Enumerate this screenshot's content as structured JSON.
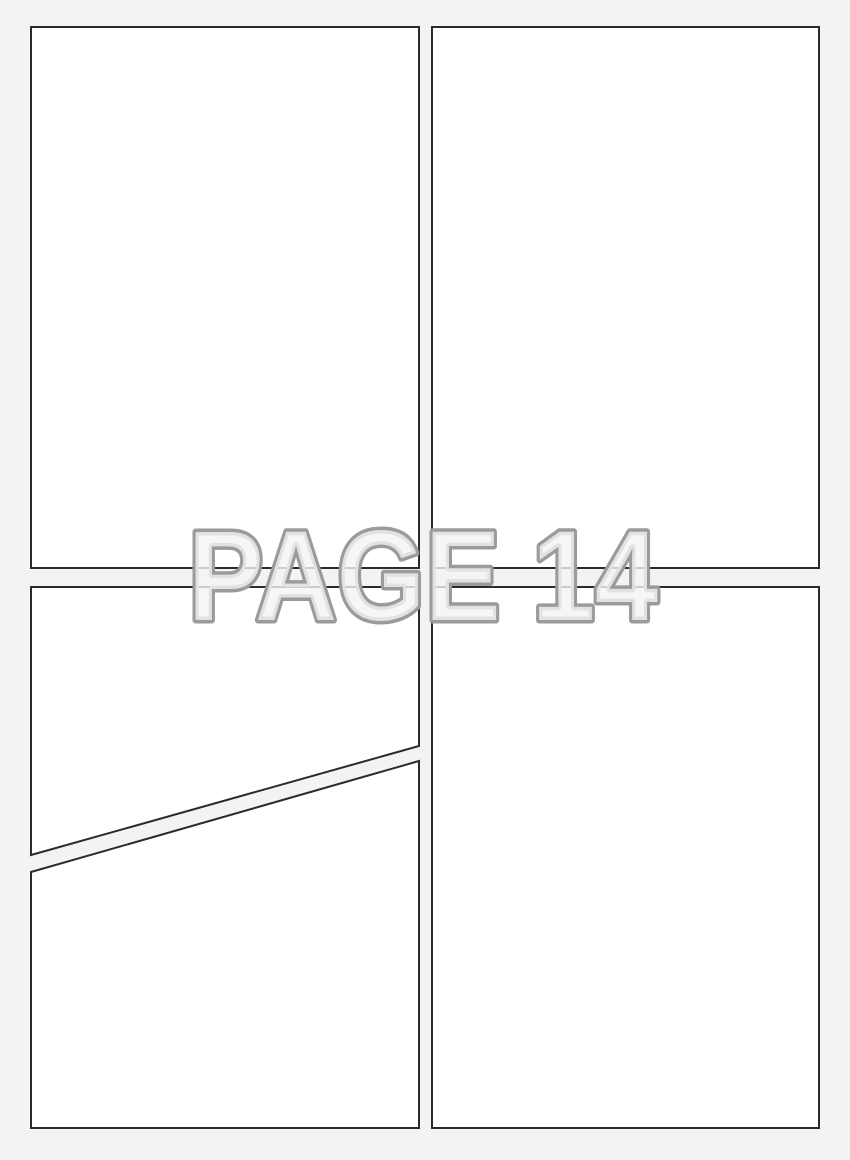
{
  "page": {
    "watermark_text": "PAGE 14",
    "panel_count": 5
  },
  "colors": {
    "page_background": "#f3f3f3",
    "panel_fill": "#ffffff",
    "panel_border": "#2b2b2b",
    "watermark_fill": "#f4f4f4",
    "watermark_outline": "#9b9b9b"
  }
}
